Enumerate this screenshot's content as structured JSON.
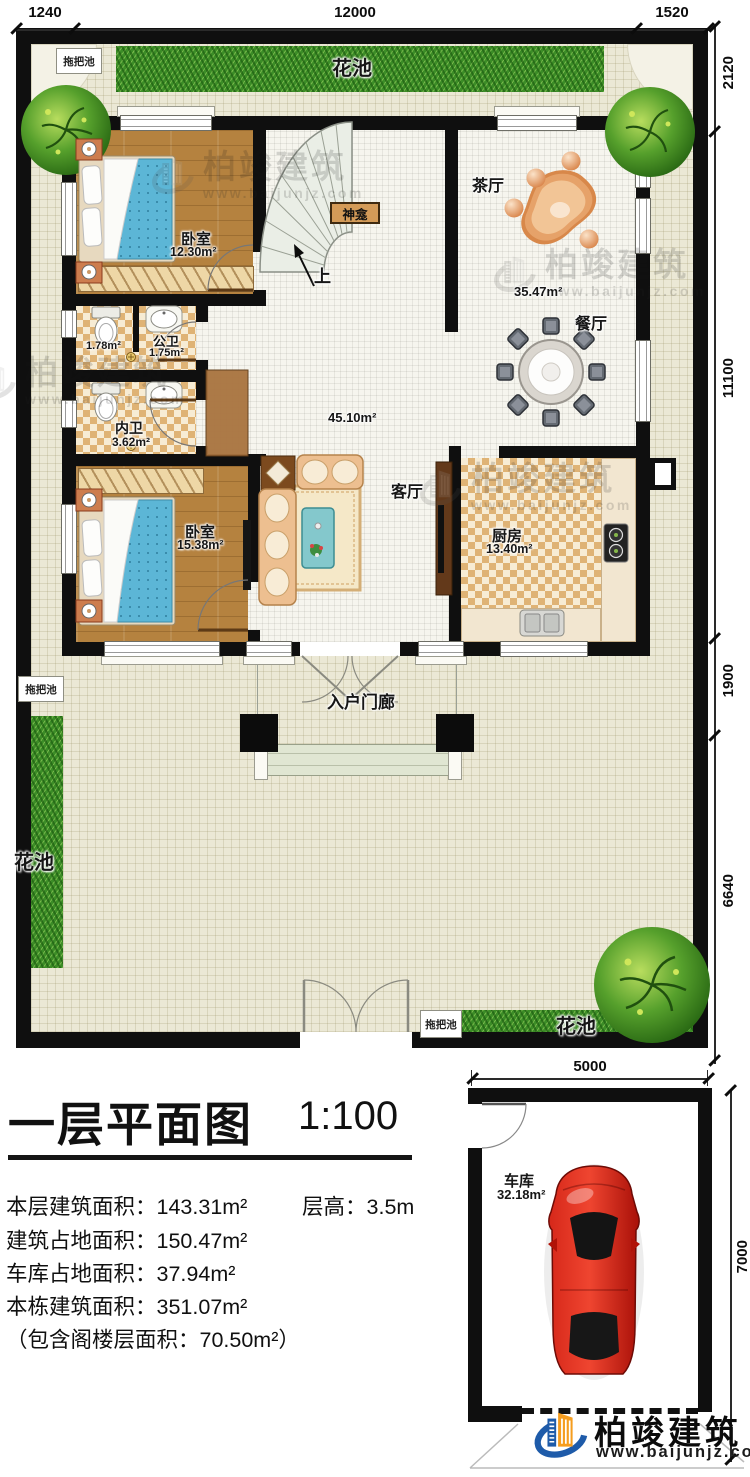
{
  "palette": {
    "wall": "#0f0f0f",
    "grass": "#3c8d27",
    "wood": "#b5823f",
    "bed_blue": "#5cb6d6",
    "car_red": "#c01208",
    "brand_blue": "#1e5ba9",
    "brand_orange": "#f59d1f"
  },
  "title": {
    "text": "一层平面图",
    "scale": "1:100"
  },
  "stats": {
    "floor_area_label": "本层建筑面积：",
    "floor_area_value": "143.31m²",
    "height_label": "层高：",
    "height_value": "3.5m",
    "footprint_label": "建筑占地面积：",
    "footprint_value": "150.47m²",
    "garage_footprint_label": "车库占地面积：",
    "garage_footprint_value": "37.94m²",
    "building_total_label": "本栋建筑面积：",
    "building_total_value": "351.07m²",
    "attic_note": "（包含阁楼层面积：70.50m²）"
  },
  "dims": {
    "top": [
      "1240",
      "12000",
      "1520"
    ],
    "right": [
      "2120",
      "11100",
      "1900",
      "6640"
    ],
    "garage_top": "5000",
    "garage_side": "7000"
  },
  "rooms": {
    "bedroom_upper": {
      "name": "卧室",
      "area": "12.30m²"
    },
    "bedroom_lower": {
      "name": "卧室",
      "area": "15.38m²"
    },
    "toilet_stall": {
      "area": "1.78m²"
    },
    "public_bath": {
      "name": "公卫",
      "area": "1.75m²"
    },
    "private_bath": {
      "name": "内卫",
      "area": "3.62m²"
    },
    "tea_hall": {
      "name": "茶厅"
    },
    "dining": {
      "name": "餐厅",
      "area": "35.47m²"
    },
    "living": {
      "name": "客厅",
      "area": "45.10m²"
    },
    "kitchen": {
      "name": "厨房",
      "area": "13.40m²"
    },
    "porch": {
      "name": "入户门廊"
    },
    "garage": {
      "name": "车库",
      "area": "32.18m²"
    },
    "shrine": {
      "name": "神龛"
    },
    "stair": {
      "up": "上"
    }
  },
  "site": {
    "flower_bed": "花池",
    "mop_pool": "拖把池"
  },
  "brand": {
    "name": "柏竣建筑",
    "url": "www.baijunjz.com"
  }
}
